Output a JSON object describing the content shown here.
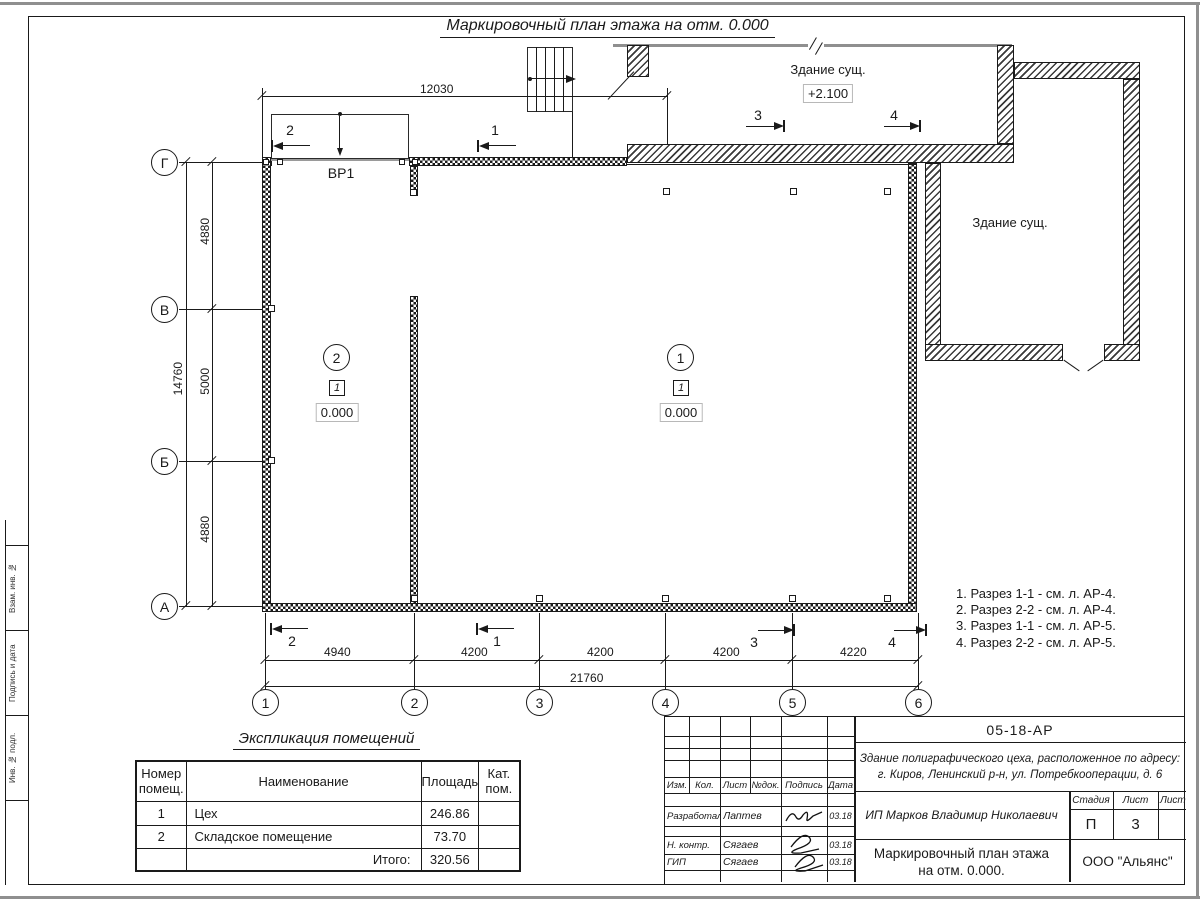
{
  "title": "Маркировочный план этажа на отм. 0.000",
  "plan": {
    "gate_label": "ВР1",
    "top_building": {
      "label": "Здание сущ.",
      "elevation": "+2.100"
    },
    "right_building": {
      "label": "Здание сущ."
    },
    "rooms": [
      {
        "circle": "2",
        "type": "1",
        "elevation": "0.000"
      },
      {
        "circle": "1",
        "type": "1",
        "elevation": "0.000"
      }
    ],
    "row_axes": [
      "Г",
      "В",
      "Б",
      "А"
    ],
    "col_axes": [
      "1",
      "2",
      "3",
      "4",
      "5",
      "6"
    ],
    "dim_top": "12030",
    "dims_left": [
      "4880",
      "5000",
      "4880"
    ],
    "dim_left_total": "14760",
    "dims_bottom": [
      "4940",
      "4200",
      "4200",
      "4200",
      "4220"
    ],
    "dim_bottom_total": "21760",
    "sections_top": [
      "2",
      "1",
      "3",
      "4"
    ],
    "sections_bottom": [
      "2",
      "1",
      "3",
      "4"
    ]
  },
  "notes": [
    "1. Разрез 1-1 - см. л. АР-4.",
    "2. Разрез 2-2 - см. л. АР-4.",
    "3. Разрез 1-1 - см. л. АР-5.",
    "4. Разрез 2-2 - см. л. АР-5."
  ],
  "schedule": {
    "title": "Экспликация помещений",
    "headers": [
      "Номер помещ.",
      "Наименование",
      "Площадь",
      "Кат. пом."
    ],
    "rows": [
      [
        "1",
        "Цех",
        "246.86",
        ""
      ],
      [
        "2",
        "Складское помещение",
        "73.70",
        ""
      ]
    ],
    "total_label": "Итого:",
    "total_value": "320.56"
  },
  "titleblock": {
    "doc_number": "05-18-АР",
    "description_line1": "Здание полиграфического цеха, расположенное по адресу:",
    "description_line2": "г. Киров,  Ленинский р-н, ул. Потребкооперации, д. 6",
    "client": "ИП Марков Владимир Николаевич",
    "columns": [
      "Изм.",
      "Кол.",
      "Лист",
      "№док.",
      "Подпись",
      "Дата"
    ],
    "rows": [
      {
        "role": "Разработал",
        "name": "Лаптев",
        "date": "03.18"
      },
      {
        "role": "Н. контр.",
        "name": "Сягаев",
        "date": "03.18"
      },
      {
        "role": "ГИП",
        "name": "Сягаев",
        "date": "03.18"
      }
    ],
    "stage_label": "Стадия",
    "sheet_label": "Лист",
    "sheets_label": "Листов",
    "stage": "П",
    "sheet": "3",
    "sheets": "",
    "title_line1": "Маркировочный план этажа",
    "title_line2": "на отм. 0.000.",
    "company": "ООО \"Альянс\""
  },
  "frame_labels": [
    "Взам. инв. №",
    "Подпись и дата",
    "Инв. № подл."
  ]
}
